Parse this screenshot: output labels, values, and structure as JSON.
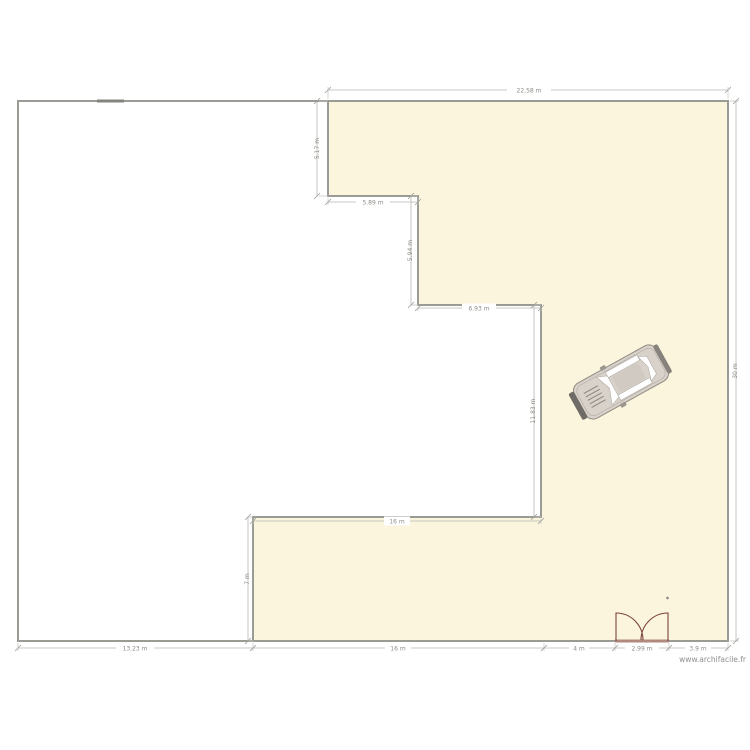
{
  "watermark": "www.archifacile.fr",
  "colors": {
    "room_fill": "#FAF5DC",
    "room_left_fill": "#FFFFFF",
    "wall": "#9B9B95",
    "dimension_line": "#B6B6B1",
    "dimension_text": "#8C8C86",
    "door": "#7C443E",
    "car_body": "#D8D2CA"
  },
  "dimensions": {
    "top_width": "22.58 m",
    "upper_left_height": "5.17 m",
    "step1_width": "5.89 m",
    "step1_height": "5.94 m",
    "step2_width": "6.93 m",
    "step2_height": "11.83 m",
    "mid_width": "16 m",
    "lower_left_height": "7 m",
    "bottom_left_width": "13.23 m",
    "bottom_main_width": "16 m",
    "bottom_seg2_width": "4 m",
    "door_width": "2.99 m",
    "bottom_right_width": "3.9 m",
    "right_height": "30 m"
  }
}
